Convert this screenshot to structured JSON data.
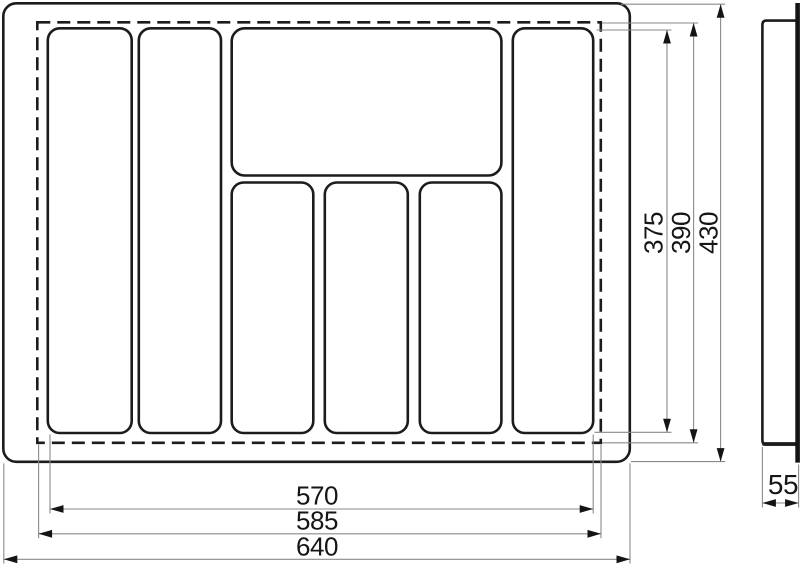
{
  "drawing": {
    "dimensions": {
      "bottom": [
        {
          "label": "570"
        },
        {
          "label": "585"
        },
        {
          "label": "640"
        }
      ],
      "right": [
        {
          "label": "375"
        },
        {
          "label": "390"
        },
        {
          "label": "430"
        }
      ],
      "side": [
        {
          "label": "55"
        }
      ]
    },
    "colors": {
      "outline": "#1c1c1c",
      "dimension_lines": "#8a8a8a",
      "text": "#161616",
      "background": "#ffffff"
    }
  }
}
